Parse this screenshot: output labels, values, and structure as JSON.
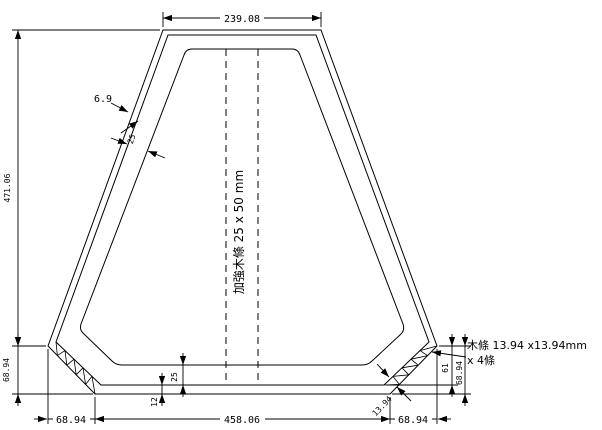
{
  "drawing": {
    "dims": {
      "top_width": "239.08",
      "total_height": "471.06",
      "left_chamfer_height": "68.94",
      "bottom_left": "68.94",
      "bottom_center": "458.06",
      "bottom_right": "68.94",
      "skin_thickness": "6.9",
      "frame_slope_width": "25",
      "strip_diagonal": "13.94",
      "bottom_frame": "25",
      "bottom_skin": "12",
      "right_inner_height": "61",
      "right_chamfer_height": "68.94"
    },
    "notes": {
      "reinforcement": "加強木條 25 x 50 mm",
      "strip_line1": "木條 13.94 x13.94mm",
      "strip_line2": "x 4條"
    },
    "colors": {
      "line": "#000000",
      "background": "#ffffff"
    }
  }
}
